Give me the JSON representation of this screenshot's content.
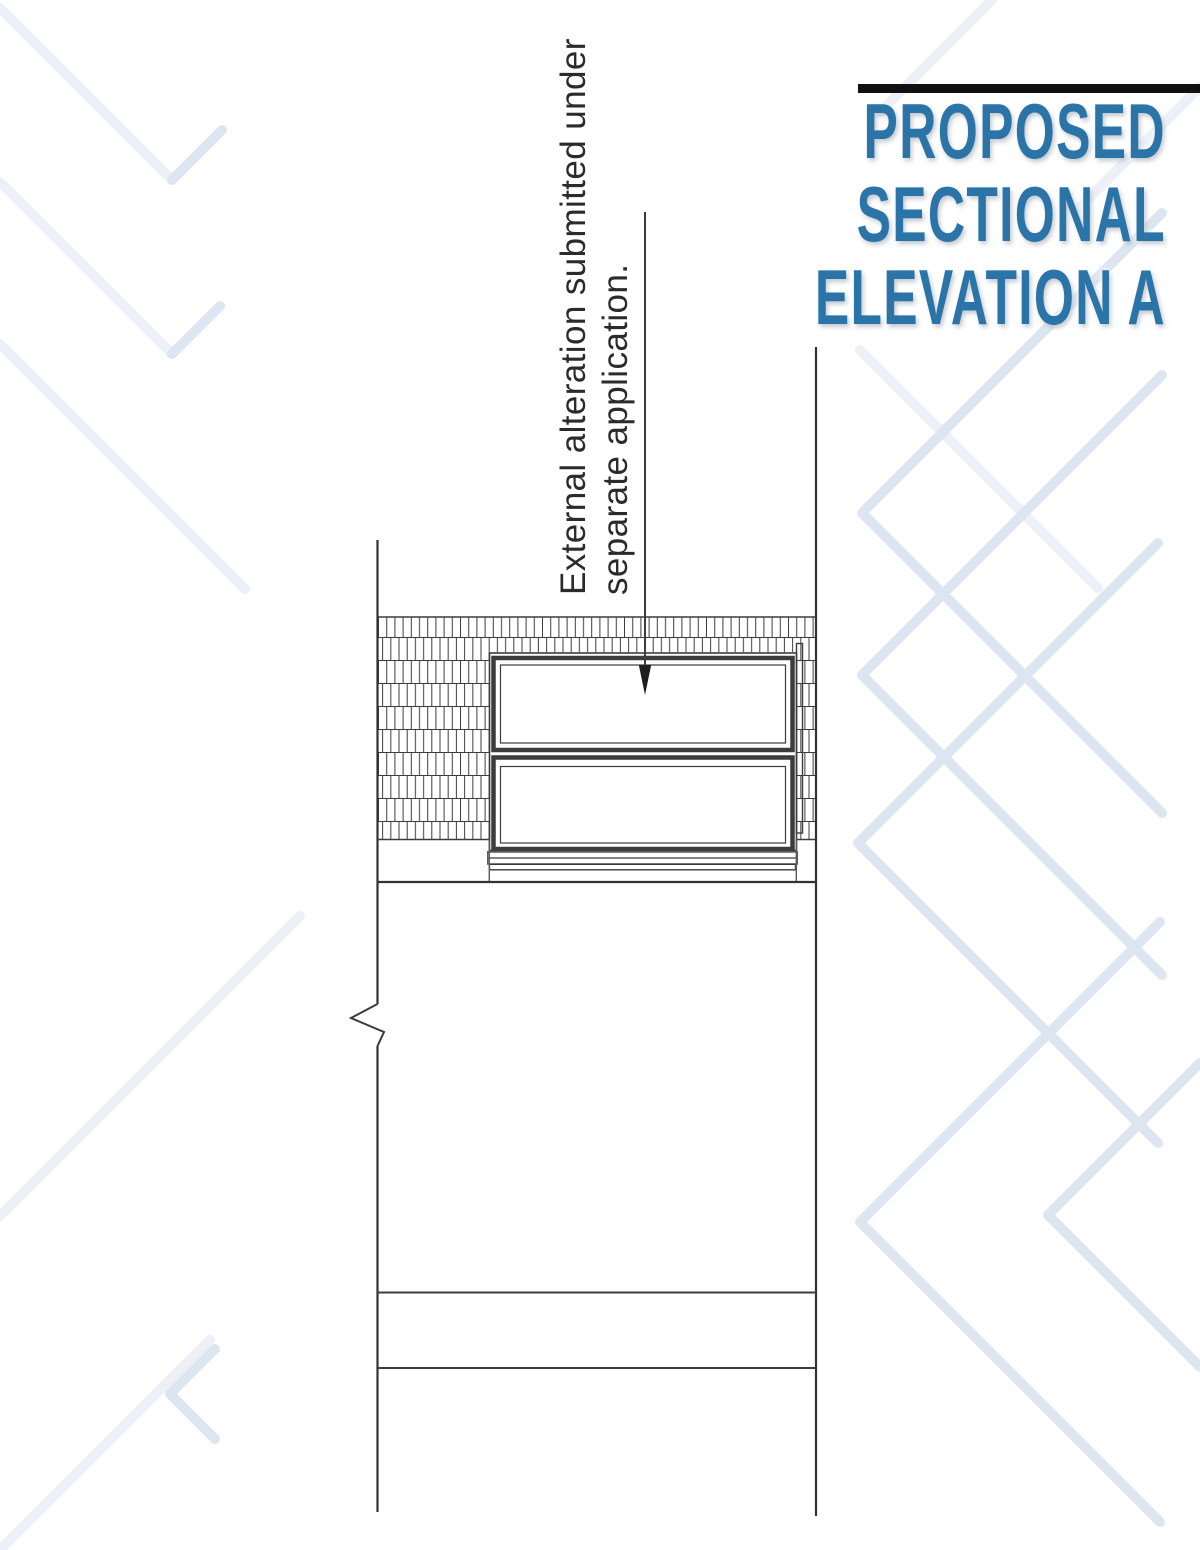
{
  "title": {
    "lines": [
      "PROPOSED",
      "SECTIONAL",
      "ELEVATION A"
    ]
  },
  "annotation": {
    "lines": [
      "External alteration submitted under",
      "separate application."
    ]
  },
  "colors": {
    "title_blue": "#2b74a8",
    "title_bar": "#111111",
    "drawing_line": "#3c3c3c",
    "hatch_line": "#757575",
    "chevron": "#dde6f0",
    "chevron_faint": "#edf1f7"
  }
}
